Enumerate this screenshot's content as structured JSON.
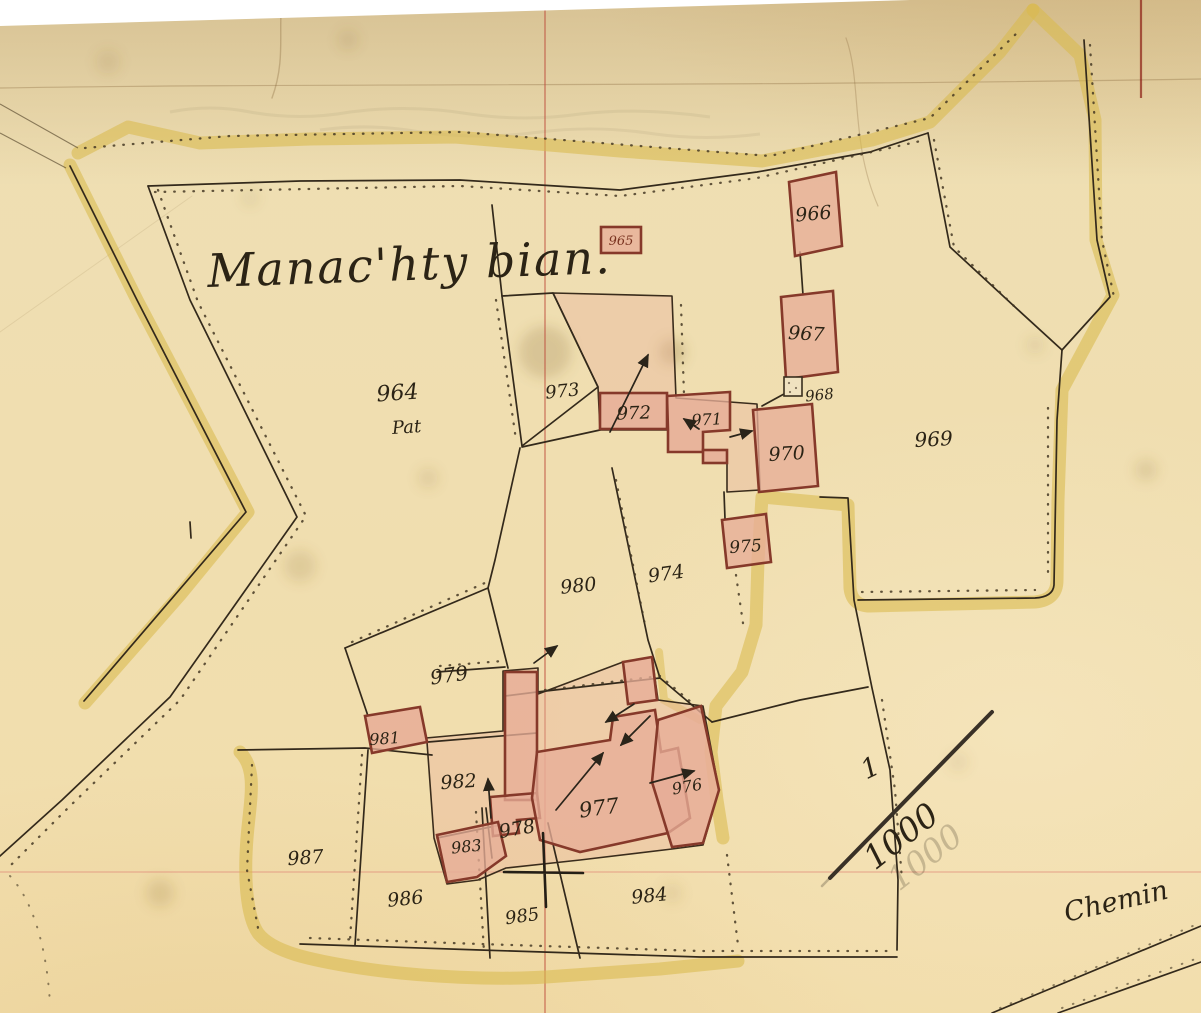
{
  "map": {
    "title": "Manac'hty bian.",
    "road_label": "Chemin",
    "scale": {
      "numerator": "1",
      "denominator": "1000"
    },
    "parcel_labels": {
      "p964": "964",
      "p964_note": "Pat",
      "p965": "965",
      "p966": "966",
      "p967": "967",
      "p968": "968",
      "p969": "969",
      "p970": "970",
      "p971": "971",
      "p972": "972",
      "p973": "973",
      "p974": "974",
      "p975": "975",
      "p976": "976",
      "p977": "977",
      "p978": "978",
      "p979": "979",
      "p980": "980",
      "p981": "981",
      "p982": "982",
      "p983": "983",
      "p984": "984",
      "p985": "985",
      "p986": "986",
      "p987": "987"
    },
    "colors": {
      "paper": "#f1dcae",
      "paper_dark": "#e6cf9d",
      "road_yellow": "#d9ba4e",
      "building_fill": "#e7ad97",
      "building_stroke": "#86392a",
      "yard_fill": "#e9b49e",
      "ink": "#2b2315",
      "grid_red": "#bc4636",
      "grid_pink": "#e28a7a"
    }
  }
}
